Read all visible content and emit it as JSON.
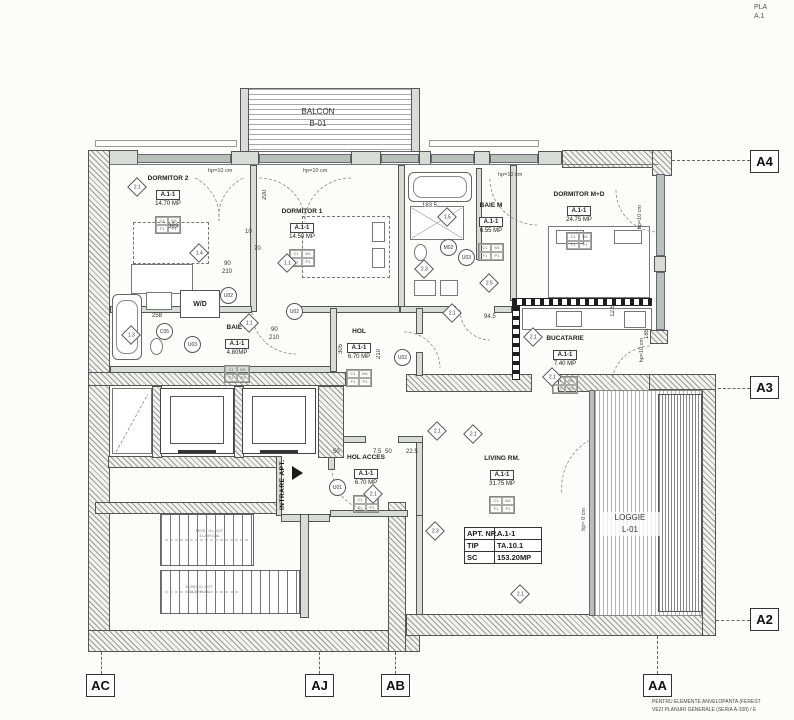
{
  "page": {
    "corner_line1": "PLA",
    "corner_line2": "A.1",
    "footer_line1": "PENTRU ELEMENTE ANVELOPANTA (FEREST",
    "footer_line2": "VEZI PLANURI GENERALE (SERIA A-100) / E"
  },
  "grid_markers": {
    "right": [
      "A4",
      "A3",
      "A2"
    ],
    "bottom": [
      "AC",
      "AJ",
      "AB",
      "AA"
    ]
  },
  "outdoor": {
    "balcony_name": "BALCON",
    "balcony_code": "B-01",
    "loggia_name": "LOGGIE",
    "loggia_code": "L-01"
  },
  "rooms": [
    {
      "name": "DORMITOR 2",
      "unit": "A.1-1",
      "area": "14.70 MP"
    },
    {
      "name": "DORMITOR 1",
      "unit": "A.1-1",
      "area": "14.50 MP"
    },
    {
      "name": "BAIE M",
      "unit": "A.1-1",
      "area": "6.55 MP"
    },
    {
      "name": "DORMITOR M+D",
      "unit": "A.1-1",
      "area": "24.75 MP"
    },
    {
      "name": "BAIE 1",
      "unit": "A.1-1",
      "area": "4.80MP"
    },
    {
      "name": "HOL",
      "unit": "A.1-1",
      "area": "6.70 MP"
    },
    {
      "name": "BUCATARIE",
      "unit": "A.1-1",
      "area": "7.40 MP"
    },
    {
      "name": "HOL ACCES",
      "unit": "A.1-1",
      "area": "6.70 MP"
    },
    {
      "name": "LIVING RM.",
      "unit": "A.1-1",
      "area": "31.75 MP"
    }
  ],
  "finish_codes": [
    "C1",
    "W1",
    "F1",
    "P1"
  ],
  "apt_info": {
    "rows": [
      {
        "k": "APT. NR.",
        "v": "A.1-1"
      },
      {
        "k": "TIP",
        "v": "TA.10.1"
      },
      {
        "k": "SC",
        "v": "153.20MP"
      }
    ]
  },
  "entrance_label": "INTRARE APT.",
  "wd_label": "W/D",
  "stair_note_line1": "MONT.CL.SGT",
  "stair_note_line2": "3.LA/H=26L",
  "sill_labels": [
    "hp=10 cm",
    "hp=10 cm",
    "hp=10 cm",
    "hp=10 cm",
    "hp=10 cm",
    "hp= 0 cm"
  ],
  "unit_tags": [
    "U02",
    "U02",
    "U03",
    "C05",
    "M02",
    "U03",
    "U02",
    "U01"
  ],
  "type_markers": [
    "2.1",
    "1.4",
    "1.1",
    "1.5",
    "2.3",
    "2.5",
    "2.1",
    "2.1",
    "2.1",
    "2.1",
    "2.1",
    "2.3",
    "2.1",
    "1.1",
    "1.3",
    "2.1"
  ],
  "dimensions": [
    "383",
    "200",
    "70",
    "90",
    "210",
    "183.5",
    "94.5",
    "258",
    "90",
    "210",
    "305",
    "210",
    "12.5",
    "185",
    "50",
    "7.5",
    "50",
    "22.5",
    "10"
  ]
}
